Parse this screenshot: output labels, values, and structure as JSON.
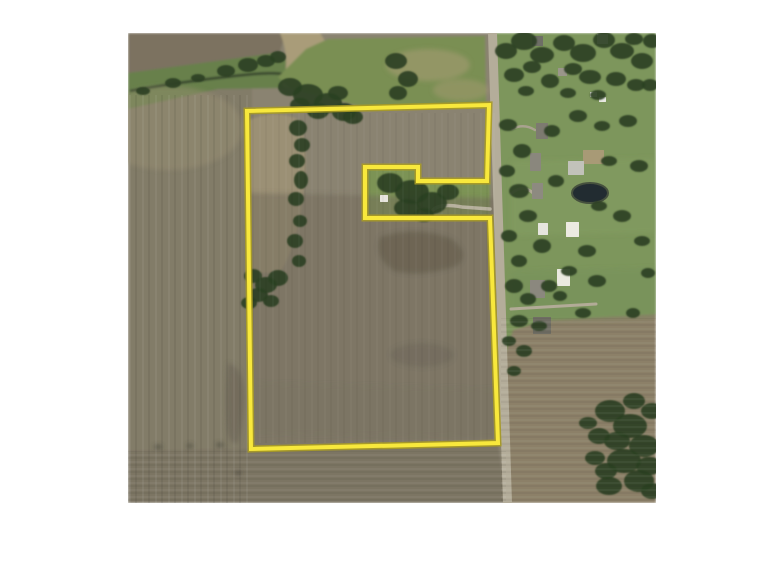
{
  "meta": {
    "kind": "aerial-property-map",
    "photo": {
      "x": 128,
      "y": 33,
      "width": 528,
      "height": 470
    },
    "page_background": "#ffffff"
  },
  "boundary": {
    "points": "119,78 361,72 359,148 290,148 290,134 237,134 237,185 362,185 370,410 123,416",
    "color": "#f8e83c",
    "halo_color": "#a89b25",
    "width": 4,
    "halo_width": 7
  },
  "road": {
    "points": "360,0 369,0 384,470 375,470",
    "fill": "#b4ad9a"
  },
  "pond": {
    "cx": 462,
    "cy": 160,
    "rx": 18,
    "ry": 10,
    "fill": "#222c31",
    "stroke": "#46513e",
    "sw": 2
  },
  "layers": {
    "tree_fill": "#2d4124",
    "fields": [
      {
        "name": "base",
        "points": "0,0 528,0 528,470 0,470",
        "fill": "#8a8371"
      },
      {
        "name": "west-field",
        "points": "0,0 124,0 124,470 0,470",
        "fill": "#827c68"
      },
      {
        "name": "south-field",
        "points": "0,418 123,416 370,410 378,470 0,470",
        "fill": "#7b7563"
      },
      {
        "name": "east-lawn",
        "points": "366,0 528,0 528,470 380,470",
        "fill": "#7d965c"
      },
      {
        "name": "se-field",
        "points": "376,470 373,335 385,297 420,287 528,281 528,470",
        "fill": "#8c8068"
      },
      {
        "name": "nw-brown-field",
        "points": "0,0 158,0 148,30 0,62",
        "fill": "#7c7260"
      },
      {
        "name": "creek-band",
        "points": "0,40 148,20 166,33 158,55 90,56 0,76",
        "fill": "#67804c"
      },
      {
        "name": "waterway",
        "d": "M152,0 L192,0 Q210,26 192,46 Q174,62 154,53 Q163,27 152,0 Z",
        "fill": "#a99c79"
      },
      {
        "name": "creek-line",
        "d": "M2,58 Q70,46 126,41 Q148,39 162,42",
        "fill": "none",
        "stroke": "#333f2a",
        "sw": 2.5
      },
      {
        "name": "ne-green-field",
        "points": "150,44 178,16 200,6 357,3 358,70 238,75 162,55",
        "fill": "#7a8f52"
      },
      {
        "name": "nw-tan-patch",
        "d": "M121,87 Q150,75 173,88 Q181,122 175,162 Q171,207 153,238 Q131,243 121,236 Z",
        "fill": "#9c9176",
        "opacity": 0.9
      },
      {
        "name": "notch-lawn",
        "points": "237,134 290,134 290,148 362,148 362,185 237,185",
        "fill": "#7b9354"
      }
    ],
    "stains": [
      {
        "points": "119,160 370,165 370,408 124,414",
        "fill": "#6f6a5a",
        "opacity": 0.5
      },
      {
        "points": "125,350 368,356 369,404 125,400",
        "fill": "#7c7361",
        "opacity": 0.45
      },
      {
        "d": "M252,204 Q290,192 324,206 Q343,221 329,233 Q292,245 266,238 Q245,224 252,204 Z",
        "fill": "#68614f",
        "opacity": 0.75
      },
      {
        "cx": 294,
        "cy": 322,
        "rx": 32,
        "ry": 12,
        "fill": "#6e6758",
        "opacity": 0.5
      },
      {
        "d": "M100,330 Q117,334 116,368 Q114,398 110,410 Q101,413 99,394 Q97,358 100,330 Z",
        "fill": "#6b6455",
        "opacity": 0.6
      },
      {
        "cx": 40,
        "cy": 95,
        "rx": 75,
        "ry": 42,
        "fill": "#989173",
        "opacity": 0.45
      },
      {
        "cx": 300,
        "cy": 32,
        "rx": 42,
        "ry": 16,
        "fill": "#a89c74",
        "opacity": 0.55
      },
      {
        "cx": 333,
        "cy": 57,
        "rx": 28,
        "ry": 11,
        "fill": "#a89c74",
        "opacity": 0.45
      },
      {
        "points": "383,128 528,125 528,200 383,203",
        "fill": "#8aa468",
        "opacity": 0.25
      },
      {
        "points": "383,238 528,235 528,285 380,290",
        "fill": "#739058",
        "opacity": 0.3
      },
      {
        "cx": 30,
        "cy": 414,
        "rx": 4,
        "ry": 2,
        "fill": "#46443a",
        "opacity": 0.8
      },
      {
        "cx": 62,
        "cy": 413,
        "rx": 3,
        "ry": 2,
        "fill": "#46443a",
        "opacity": 0.8
      },
      {
        "cx": 92,
        "cy": 412,
        "rx": 4,
        "ry": 2,
        "fill": "#46443a",
        "opacity": 0.8
      },
      {
        "cx": 110,
        "cy": 440,
        "rx": 3,
        "ry": 2,
        "fill": "#46443a",
        "opacity": 0.7
      }
    ],
    "driveways": [
      {
        "d": "M362,176 L334,174 Q312,170 305,177",
        "w": 3.5,
        "color": "#b7b19e"
      },
      {
        "d": "M383,276 L468,271",
        "w": 3,
        "color": "#b2ab97"
      },
      {
        "d": "M384,160 Q395,151 405,160",
        "w": 3,
        "color": "#b2ab97"
      },
      {
        "d": "M384,96 Q396,90 407,97",
        "w": 2.5,
        "color": "#a9a28f"
      }
    ],
    "buildings": [
      [
        404,
        3,
        11,
        10,
        "#6e6e66"
      ],
      [
        469,
        1,
        11,
        10,
        "#e9e9e4"
      ],
      [
        430,
        35,
        9,
        8,
        "#9a968a"
      ],
      [
        462,
        59,
        7,
        5,
        "#e8e8e2"
      ],
      [
        471,
        64,
        7,
        5,
        "#e8e8e2"
      ],
      [
        408,
        90,
        12,
        16,
        "#7d7a70"
      ],
      [
        455,
        117,
        21,
        14,
        "#a89a76"
      ],
      [
        440,
        128,
        16,
        14,
        "#c2c2ba"
      ],
      [
        402,
        120,
        11,
        18,
        "#8a877d"
      ],
      [
        404,
        150,
        11,
        16,
        "#8d8a80"
      ],
      [
        410,
        190,
        10,
        12,
        "#e6e5de"
      ],
      [
        438,
        189,
        13,
        15,
        "#eceae1"
      ],
      [
        429,
        236,
        13,
        17,
        "#eae9e0"
      ],
      [
        402,
        247,
        15,
        18,
        "#8b887e"
      ],
      [
        405,
        284,
        18,
        17,
        "#6f6d63"
      ],
      [
        252,
        162,
        8,
        7,
        "#e8e6de"
      ]
    ],
    "trees": [
      [
        15,
        58,
        7,
        4
      ],
      [
        45,
        50,
        8,
        5
      ],
      [
        70,
        45,
        7,
        4
      ],
      [
        98,
        38,
        9,
        6
      ],
      [
        120,
        32,
        10,
        7
      ],
      [
        138,
        28,
        9,
        6
      ],
      [
        150,
        24,
        8,
        6
      ],
      [
        162,
        54,
        12,
        9
      ],
      [
        180,
        62,
        15,
        11
      ],
      [
        200,
        70,
        14,
        10
      ],
      [
        216,
        79,
        12,
        9
      ],
      [
        190,
        78,
        11,
        8
      ],
      [
        172,
        72,
        10,
        7
      ],
      [
        210,
        60,
        10,
        7
      ],
      [
        225,
        84,
        10,
        7
      ],
      [
        170,
        95,
        9,
        8
      ],
      [
        174,
        112,
        8,
        7
      ],
      [
        169,
        128,
        8,
        7
      ],
      [
        173,
        147,
        7,
        9
      ],
      [
        168,
        166,
        8,
        7
      ],
      [
        172,
        188,
        7,
        6
      ],
      [
        167,
        208,
        8,
        7
      ],
      [
        171,
        228,
        7,
        6
      ],
      [
        150,
        245,
        10,
        8
      ],
      [
        138,
        252,
        11,
        8
      ],
      [
        125,
        243,
        9,
        7
      ],
      [
        130,
        262,
        10,
        7
      ],
      [
        121,
        270,
        8,
        6
      ],
      [
        143,
        268,
        8,
        6
      ],
      [
        262,
        150,
        13,
        10
      ],
      [
        284,
        159,
        17,
        12
      ],
      [
        304,
        170,
        15,
        11
      ],
      [
        279,
        175,
        13,
        9
      ],
      [
        320,
        159,
        11,
        8
      ],
      [
        296,
        182,
        10,
        7
      ],
      [
        268,
        28,
        11,
        8
      ],
      [
        280,
        46,
        10,
        8
      ],
      [
        270,
        60,
        9,
        7
      ],
      [
        378,
        18,
        11,
        8
      ],
      [
        396,
        8,
        13,
        9
      ],
      [
        414,
        22,
        12,
        8
      ],
      [
        436,
        10,
        11,
        8
      ],
      [
        455,
        20,
        13,
        9
      ],
      [
        476,
        7,
        11,
        8
      ],
      [
        494,
        18,
        12,
        8
      ],
      [
        514,
        28,
        11,
        8
      ],
      [
        506,
        6,
        9,
        6
      ],
      [
        524,
        8,
        9,
        7
      ],
      [
        386,
        42,
        10,
        7
      ],
      [
        404,
        34,
        9,
        6
      ],
      [
        422,
        48,
        9,
        7
      ],
      [
        445,
        36,
        9,
        6
      ],
      [
        462,
        44,
        11,
        7
      ],
      [
        488,
        46,
        10,
        7
      ],
      [
        508,
        52,
        9,
        6
      ],
      [
        522,
        52,
        8,
        6
      ],
      [
        440,
        60,
        8,
        5
      ],
      [
        470,
        62,
        8,
        5
      ],
      [
        398,
        58,
        8,
        5
      ],
      [
        380,
        92,
        9,
        6
      ],
      [
        394,
        118,
        9,
        7
      ],
      [
        379,
        138,
        8,
        6
      ],
      [
        391,
        158,
        10,
        7
      ],
      [
        400,
        183,
        9,
        6
      ],
      [
        381,
        203,
        8,
        6
      ],
      [
        414,
        213,
        9,
        7
      ],
      [
        391,
        228,
        8,
        6
      ],
      [
        428,
        148,
        8,
        6
      ],
      [
        424,
        98,
        8,
        6
      ],
      [
        450,
        83,
        9,
        6
      ],
      [
        474,
        93,
        8,
        5
      ],
      [
        500,
        88,
        9,
        6
      ],
      [
        481,
        128,
        8,
        5
      ],
      [
        511,
        133,
        9,
        6
      ],
      [
        471,
        173,
        8,
        5
      ],
      [
        494,
        183,
        9,
        6
      ],
      [
        514,
        208,
        8,
        5
      ],
      [
        459,
        218,
        9,
        6
      ],
      [
        441,
        238,
        8,
        5
      ],
      [
        469,
        248,
        9,
        6
      ],
      [
        421,
        253,
        8,
        6
      ],
      [
        386,
        253,
        9,
        7
      ],
      [
        400,
        266,
        8,
        6
      ],
      [
        432,
        263,
        7,
        5
      ],
      [
        391,
        288,
        9,
        6
      ],
      [
        411,
        293,
        8,
        5
      ],
      [
        381,
        308,
        7,
        5
      ],
      [
        396,
        318,
        8,
        6
      ],
      [
        386,
        338,
        7,
        5
      ],
      [
        455,
        280,
        8,
        5
      ],
      [
        505,
        280,
        7,
        5
      ],
      [
        520,
        240,
        7,
        5
      ],
      [
        482,
        378,
        15,
        11
      ],
      [
        502,
        393,
        17,
        12
      ],
      [
        516,
        413,
        15,
        11
      ],
      [
        496,
        428,
        17,
        12
      ],
      [
        511,
        448,
        15,
        11
      ],
      [
        481,
        453,
        13,
        9
      ],
      [
        524,
        378,
        11,
        8
      ],
      [
        521,
        433,
        13,
        9
      ],
      [
        471,
        403,
        11,
        8
      ],
      [
        489,
        408,
        13,
        9
      ],
      [
        506,
        368,
        11,
        8
      ],
      [
        524,
        458,
        11,
        8
      ],
      [
        467,
        425,
        10,
        7
      ],
      [
        478,
        438,
        11,
        8
      ],
      [
        460,
        390,
        9,
        6
      ]
    ]
  }
}
